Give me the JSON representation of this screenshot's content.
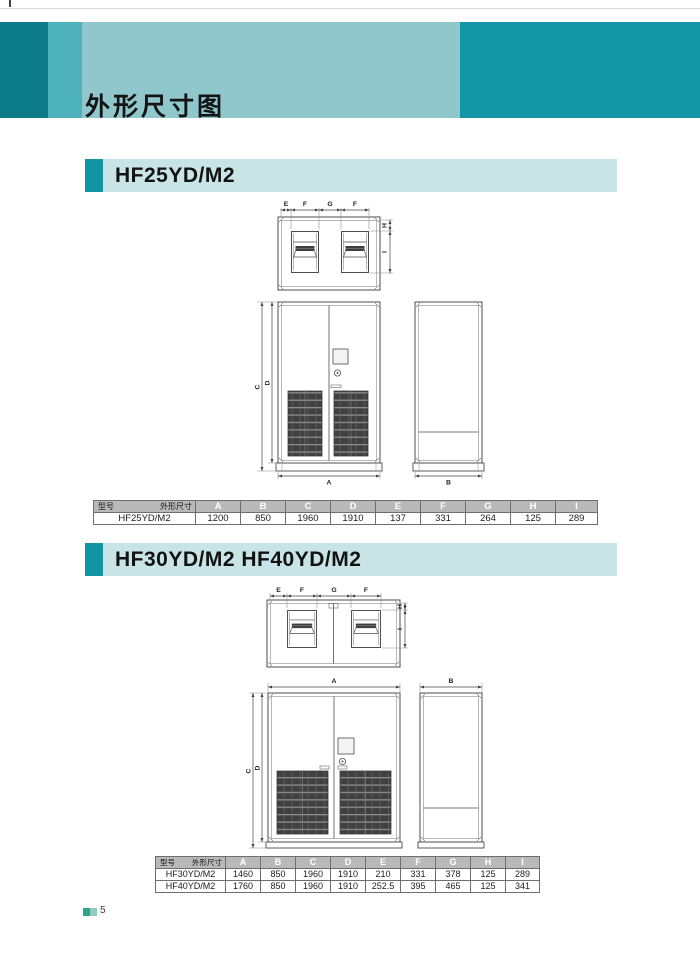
{
  "page": {
    "title": "外形尺寸图",
    "page_number": "5"
  },
  "colors": {
    "banner_dark_left": "#0c7c8a",
    "banner_mid_strip": "#4db2bc",
    "banner_light": "#8fc7cc",
    "banner_dark_right": "#1397a6",
    "section_bar_bg": "#c9e4e6",
    "section_bar_accent": "#1294a3",
    "table_header_bg": "#b9b9b9",
    "footer_square_dark": "#31a08e",
    "footer_square_light": "#90cbbd"
  },
  "drawing_labels": {
    "a": "A",
    "b": "B",
    "c": "C",
    "d": "D",
    "e": "E",
    "f": "F",
    "g": "G",
    "h": "H",
    "i": "I"
  },
  "sections": [
    {
      "heading": "HF25YD/M2",
      "table": {
        "corner_top": "外形尺寸",
        "corner_bottom": "型号",
        "columns": [
          "A",
          "B",
          "C",
          "D",
          "E",
          "F",
          "G",
          "H",
          "I"
        ],
        "rows": [
          {
            "model": "HF25YD/M2",
            "values": [
              "1200",
              "850",
              "1960",
              "1910",
              "137",
              "331",
              "264",
              "125",
              "289"
            ]
          }
        ]
      }
    },
    {
      "heading": "HF30YD/M2 HF40YD/M2",
      "table": {
        "corner_top": "外形尺寸",
        "corner_bottom": "型号",
        "columns": [
          "A",
          "B",
          "C",
          "D",
          "E",
          "F",
          "G",
          "H",
          "I"
        ],
        "rows": [
          {
            "model": "HF30YD/M2",
            "values": [
              "1460",
              "850",
              "1960",
              "1910",
              "210",
              "331",
              "378",
              "125",
              "289"
            ]
          },
          {
            "model": "HF40YD/M2",
            "values": [
              "1760",
              "850",
              "1960",
              "1910",
              "252.5",
              "395",
              "465",
              "125",
              "341"
            ]
          }
        ]
      }
    }
  ]
}
